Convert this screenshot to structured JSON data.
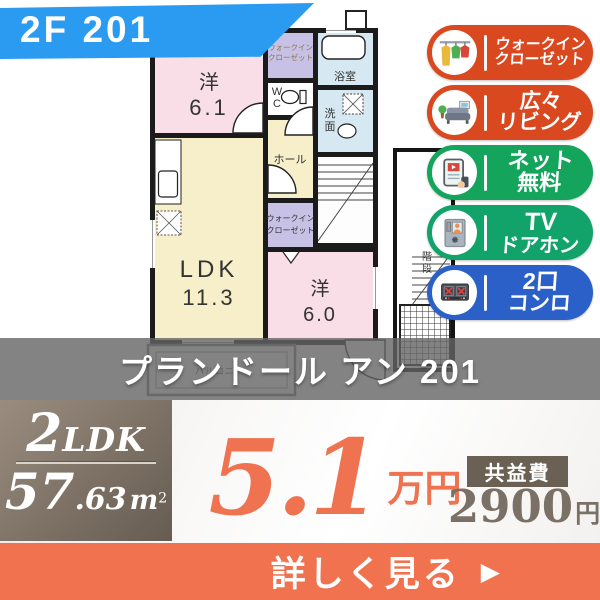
{
  "unit_badge": {
    "label": "2F 201"
  },
  "floor_plan": {
    "bedroom1_label": "洋",
    "bedroom1_size": "6.1",
    "ldk_label": "LDK",
    "ldk_size": "11.3",
    "bedroom2_label": "洋",
    "bedroom2_size": "6.0",
    "wic_top_line1": "ウォークイン",
    "wic_top_line2": "クローゼット",
    "wic_mid_line1": "ウォークイン",
    "wic_mid_line2": "クローゼット",
    "bath_label": "浴室",
    "wash_line1": "洗",
    "wash_line2": "面",
    "wc_line1": "W",
    "wc_line2": "C",
    "hall_label": "ホール",
    "stairs_line1": "階",
    "stairs_line2": "段",
    "balcony_label": "バルコニー"
  },
  "feature_badges": [
    {
      "line1": "ウォークイン",
      "line2": "クローゼット",
      "color": "#d9481e",
      "icon": "closet-icon"
    },
    {
      "line1": "広々",
      "line2": "リビング",
      "color": "#d9481e",
      "icon": "sofa-icon"
    },
    {
      "line1": "ネット",
      "line2": "無料",
      "color": "#14a45c",
      "icon": "net-tablet-icon"
    },
    {
      "line1": "TV",
      "line2": "ドアホン",
      "color": "#12a36b",
      "icon": "doorphone-icon"
    },
    {
      "line1": "2口",
      "line2": "コンロ",
      "color": "#2b60c8",
      "icon": "stove-icon"
    }
  ],
  "property": {
    "name": "プランドール アン 201"
  },
  "summary": {
    "layout": "2LDK",
    "layout_big": "2",
    "layout_rest": "LDK",
    "area_int": "57",
    "area_dec": ".63",
    "area_unit_base": "m",
    "area_unit_sup": "2"
  },
  "price": {
    "rent_value": "5.1",
    "rent_unit": "万円",
    "fee_label": "共益費",
    "fee_value": "2900",
    "fee_unit": "円"
  },
  "cta": {
    "label": "詳しく見る",
    "arrow": "▶"
  },
  "colors": {
    "banner_blue": "#2b9bf1",
    "badge_orange": "#d9481e",
    "badge_green": "#14a45c",
    "badge_teal_green": "#12a36b",
    "badge_blue": "#2b60c8",
    "price_orange": "#ef7350",
    "cta_orange": "#f0724e",
    "spec_taupe": "#6b6054"
  }
}
